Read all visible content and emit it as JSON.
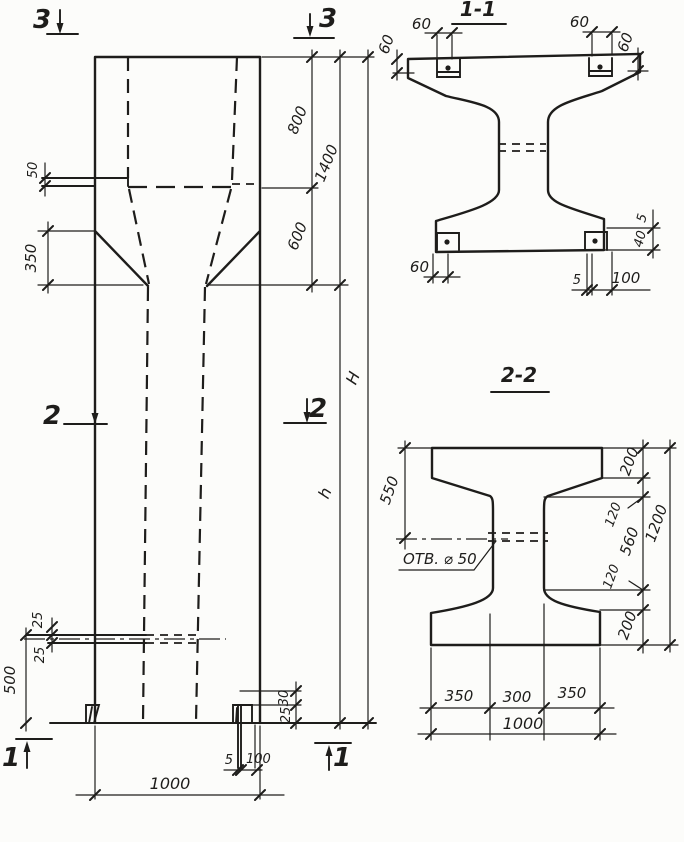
{
  "meta": {
    "paper": "#fcfcfa",
    "ink": "#1e1d1b",
    "drawing_type": "reinforced concrete column elevation with sections"
  },
  "elevation": {
    "marks": {
      "top_left": "3",
      "top_right": "3",
      "mid_left": "2",
      "mid_right": "2",
      "bottom_left": "1",
      "bottom_right": "1"
    },
    "dims": {
      "ledge_thickness": "50",
      "taper_height": "350",
      "upper_800": "800",
      "upper_600": "600",
      "upper_total": "1400",
      "total_height": "H",
      "shaft_height": "h",
      "slot_25_top": "25",
      "slot_25_bottom": "25",
      "bottom_500": "500",
      "foot_30": "30",
      "foot_25": "25",
      "anchor_5": "5",
      "anchor_100": "100",
      "width_1000": "1000"
    }
  },
  "section_1_1": {
    "title": "1-1",
    "dims": {
      "plate_left_60": "60",
      "edge_left_60": "60",
      "plate_right_60": "60",
      "edge_right_60": "60",
      "plate_bottom_60": "60",
      "bottom_5": "5",
      "bottom_100": "100",
      "right_5": "5",
      "right_40": "40"
    }
  },
  "section_2_2": {
    "title": "2-2",
    "hole_label": "ОТВ. ⌀ 50",
    "dims": {
      "left_550": "550",
      "right_200_top": "200",
      "right_120_top": "120",
      "right_560": "560",
      "right_120_bottom": "120",
      "right_200_bottom": "200",
      "right_total_1200": "1200",
      "bottom_350_left": "350",
      "bottom_300": "300",
      "bottom_350_right": "350",
      "bottom_total_1000": "1000"
    }
  }
}
